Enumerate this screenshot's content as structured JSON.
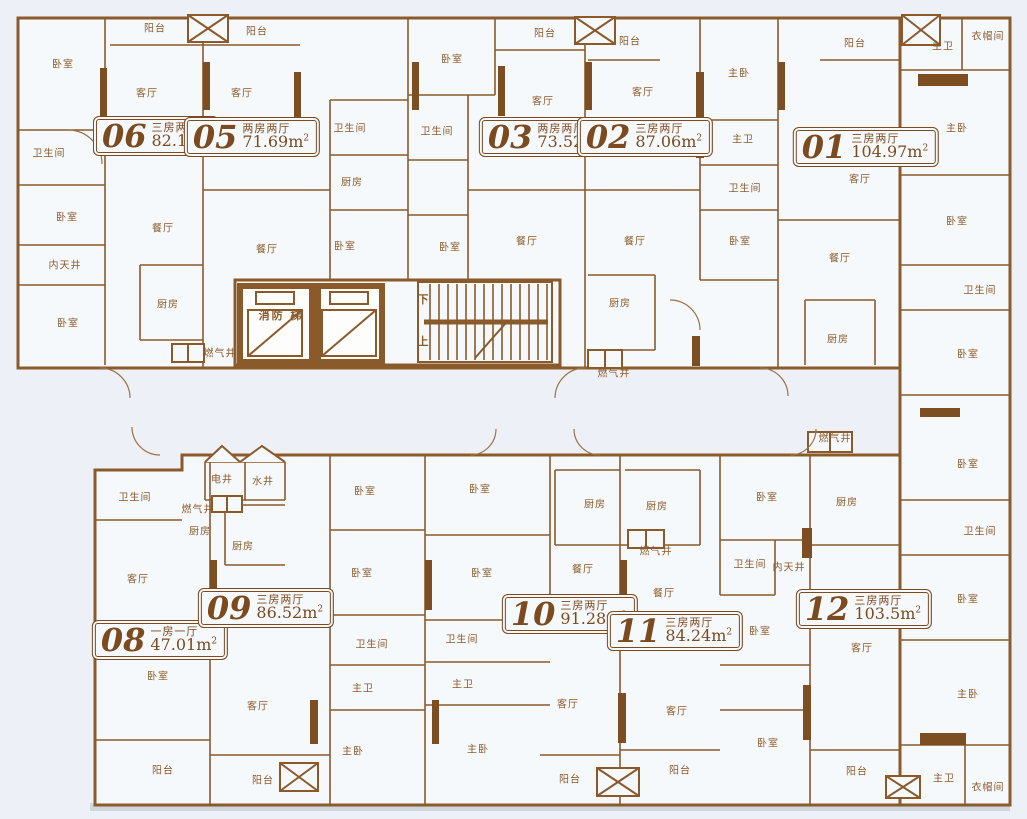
{
  "colors": {
    "wall": "#8a5a2b",
    "wall_dark": "#7d4e22",
    "room_fill": "#f6f9fc",
    "background": "#edf1f7",
    "label_text": "#8a5b2b",
    "plaque_text": "#7b4a1e"
  },
  "plan": {
    "core": {
      "fire_elevator_label": "消防 梯",
      "stair_down_label": "下",
      "stair_up_label": "上"
    },
    "units": [
      {
        "no": "06",
        "type": "三房两厅",
        "area": "82.1",
        "x": 156,
        "y": 136
      },
      {
        "no": "05",
        "type": "两房两厅",
        "area": "71.69",
        "x": 252,
        "y": 137
      },
      {
        "no": "03",
        "type": "两房两厅",
        "area": "73.52",
        "x": 547,
        "y": 137
      },
      {
        "no": "02",
        "type": "三房两厅",
        "area": "87.06",
        "x": 645,
        "y": 137
      },
      {
        "no": "01",
        "type": "三房两厅",
        "area": "104.97",
        "x": 866,
        "y": 147
      },
      {
        "no": "08",
        "type": "一房一厅",
        "area": "47.01",
        "x": 160,
        "y": 640
      },
      {
        "no": "09",
        "type": "三房两厅",
        "area": "86.52",
        "x": 266,
        "y": 608
      },
      {
        "no": "10",
        "type": "三房两厅",
        "area": "91.28",
        "x": 570,
        "y": 614
      },
      {
        "no": "11",
        "type": "三房两厅",
        "area": "84.24",
        "x": 675,
        "y": 631
      },
      {
        "no": "12",
        "type": "三房两厅",
        "area": "103.5",
        "x": 864,
        "y": 609
      }
    ],
    "rooms": [
      {
        "label": "阳台",
        "x": 155,
        "y": 27
      },
      {
        "label": "阳台",
        "x": 257,
        "y": 30
      },
      {
        "label": "卧室",
        "x": 63,
        "y": 63
      },
      {
        "label": "客厅",
        "x": 147,
        "y": 92
      },
      {
        "label": "卫生间",
        "x": 49,
        "y": 152
      },
      {
        "label": "卧室",
        "x": 67,
        "y": 216
      },
      {
        "label": "内天井",
        "x": 65,
        "y": 264
      },
      {
        "label": "卧室",
        "x": 68,
        "y": 322
      },
      {
        "label": "餐厅",
        "x": 163,
        "y": 227
      },
      {
        "label": "厨房",
        "x": 168,
        "y": 303
      },
      {
        "label": "燃气井",
        "x": 220,
        "y": 352
      },
      {
        "label": "客厅",
        "x": 242,
        "y": 92
      },
      {
        "label": "餐厅",
        "x": 267,
        "y": 248
      },
      {
        "label": "卫生间",
        "x": 350,
        "y": 127
      },
      {
        "label": "厨房",
        "x": 352,
        "y": 181
      },
      {
        "label": "卧室",
        "x": 345,
        "y": 245
      },
      {
        "label": "阳台",
        "x": 545,
        "y": 32
      },
      {
        "label": "卧室",
        "x": 452,
        "y": 58
      },
      {
        "label": "客厅",
        "x": 543,
        "y": 100
      },
      {
        "label": "卫生间",
        "x": 437,
        "y": 130
      },
      {
        "label": "卧室",
        "x": 450,
        "y": 246
      },
      {
        "label": "餐厅",
        "x": 527,
        "y": 240
      },
      {
        "label": "阳台",
        "x": 630,
        "y": 40
      },
      {
        "label": "客厅",
        "x": 643,
        "y": 91
      },
      {
        "label": "主卧",
        "x": 739,
        "y": 72
      },
      {
        "label": "主卫",
        "x": 743,
        "y": 138
      },
      {
        "label": "卫生间",
        "x": 745,
        "y": 187
      },
      {
        "label": "餐厅",
        "x": 635,
        "y": 240
      },
      {
        "label": "卧室",
        "x": 740,
        "y": 240
      },
      {
        "label": "厨房",
        "x": 620,
        "y": 302
      },
      {
        "label": "燃气井",
        "x": 614,
        "y": 372
      },
      {
        "label": "阳台",
        "x": 855,
        "y": 42
      },
      {
        "label": "主卫",
        "x": 943,
        "y": 45
      },
      {
        "label": "衣帽间",
        "x": 988,
        "y": 35
      },
      {
        "label": "客厅",
        "x": 860,
        "y": 178
      },
      {
        "label": "主卧",
        "x": 957,
        "y": 127
      },
      {
        "label": "餐厅",
        "x": 840,
        "y": 257
      },
      {
        "label": "卧室",
        "x": 957,
        "y": 220
      },
      {
        "label": "卫生间",
        "x": 980,
        "y": 289
      },
      {
        "label": "厨房",
        "x": 838,
        "y": 338
      },
      {
        "label": "卧室",
        "x": 968,
        "y": 353
      },
      {
        "label": "卧室",
        "x": 968,
        "y": 463
      },
      {
        "label": "卫生间",
        "x": 980,
        "y": 530
      },
      {
        "label": "卫生间",
        "x": 135,
        "y": 496
      },
      {
        "label": "电井",
        "x": 222,
        "y": 478
      },
      {
        "label": "水井",
        "x": 263,
        "y": 480
      },
      {
        "label": "燃气井",
        "x": 198,
        "y": 508
      },
      {
        "label": "厨房",
        "x": 200,
        "y": 530
      },
      {
        "label": "厨房",
        "x": 243,
        "y": 545
      },
      {
        "label": "客厅",
        "x": 138,
        "y": 578
      },
      {
        "label": "卧室",
        "x": 158,
        "y": 675
      },
      {
        "label": "阳台",
        "x": 163,
        "y": 769
      },
      {
        "label": "客厅",
        "x": 258,
        "y": 705
      },
      {
        "label": "阳台",
        "x": 263,
        "y": 779
      },
      {
        "label": "主卧",
        "x": 353,
        "y": 750
      },
      {
        "label": "卧室",
        "x": 365,
        "y": 490
      },
      {
        "label": "卧室",
        "x": 362,
        "y": 572
      },
      {
        "label": "卫生间",
        "x": 372,
        "y": 643
      },
      {
        "label": "主卫",
        "x": 363,
        "y": 687
      },
      {
        "label": "卧室",
        "x": 480,
        "y": 488
      },
      {
        "label": "卧室",
        "x": 482,
        "y": 572
      },
      {
        "label": "卫生间",
        "x": 462,
        "y": 638
      },
      {
        "label": "主卫",
        "x": 463,
        "y": 683
      },
      {
        "label": "厨房",
        "x": 595,
        "y": 503
      },
      {
        "label": "餐厅",
        "x": 583,
        "y": 568
      },
      {
        "label": "燃气井",
        "x": 656,
        "y": 550
      },
      {
        "label": "厨房",
        "x": 657,
        "y": 505
      },
      {
        "label": "客厅",
        "x": 568,
        "y": 703
      },
      {
        "label": "主卧",
        "x": 478,
        "y": 748
      },
      {
        "label": "阳台",
        "x": 570,
        "y": 778
      },
      {
        "label": "餐厅",
        "x": 664,
        "y": 592
      },
      {
        "label": "客厅",
        "x": 677,
        "y": 710
      },
      {
        "label": "阳台",
        "x": 680,
        "y": 769
      },
      {
        "label": "卧室",
        "x": 767,
        "y": 496
      },
      {
        "label": "卫生间",
        "x": 750,
        "y": 563
      },
      {
        "label": "内天井",
        "x": 789,
        "y": 566
      },
      {
        "label": "卧室",
        "x": 760,
        "y": 630
      },
      {
        "label": "卧室",
        "x": 768,
        "y": 742
      },
      {
        "label": "燃气井",
        "x": 835,
        "y": 437
      },
      {
        "label": "厨房",
        "x": 847,
        "y": 501
      },
      {
        "label": "客厅",
        "x": 862,
        "y": 647
      },
      {
        "label": "阳台",
        "x": 857,
        "y": 770
      },
      {
        "label": "卧室",
        "x": 968,
        "y": 598
      },
      {
        "label": "主卧",
        "x": 968,
        "y": 693
      },
      {
        "label": "主卫",
        "x": 944,
        "y": 777
      },
      {
        "label": "衣帽间",
        "x": 988,
        "y": 786
      }
    ]
  }
}
